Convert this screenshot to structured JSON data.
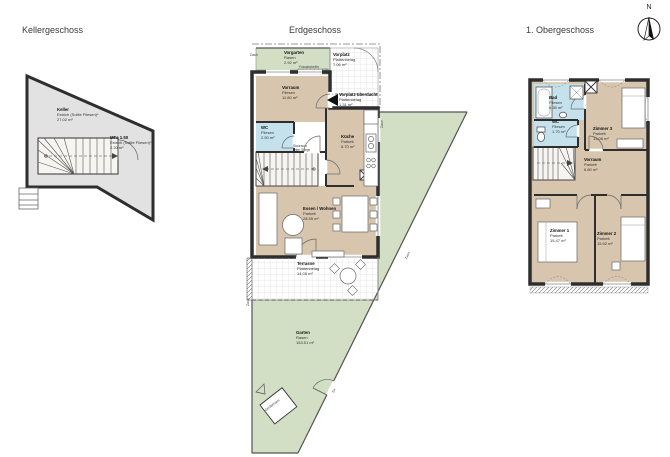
{
  "north_arrow": {
    "label": "N"
  },
  "colors": {
    "wood": "#d8c5ae",
    "tile_blue": "#c5e2ec",
    "grass": "#d2dfc5",
    "screed_gray": "#e2e2e2",
    "wall": "#2e2e2e"
  },
  "keller": {
    "title": "Kellergeschoss",
    "rooms": {
      "keller": {
        "name": "Keller",
        "floor": "Estrich (Sollte Fliesen)*",
        "area": "27.02 m²"
      },
      "stiege": {
        "name": "MFa 1.50",
        "floor": "Estrich (Sollte Fliesen)*",
        "area": "2.20 m²"
      }
    }
  },
  "eg": {
    "title": "Erdgeschoss",
    "annotations": {
      "dach": "Dach",
      "zaun": "Zaun",
      "tor": "Tor",
      "geraetehaus": "Gerätehaus",
      "stauraum_line1": "Stauraum",
      "stauraum_line2": "unter Stiege",
      "fussabstreifer": "Fussabstreifer"
    },
    "rooms": {
      "vorgarten": {
        "name": "Vorgarten",
        "floor": "Rasen",
        "area": "2.92 m²"
      },
      "vorplatz": {
        "name": "Vorplatz",
        "floor": "Plattenbelag",
        "area": "7.06 m²"
      },
      "vorplatz_ueberdacht": {
        "name": "Vorplatz überdacht",
        "floor": "Plattenbelag",
        "area": "1.31 m²"
      },
      "vorraum": {
        "name": "Vorraum",
        "floor": "Fliesen",
        "area": "11.80 m²"
      },
      "wc": {
        "name": "WC",
        "floor": "Fliesen",
        "area": "2.50 m²"
      },
      "kueche": {
        "name": "Küche",
        "floor": "Parkett",
        "area": "6.70 m²"
      },
      "essen_wohnen": {
        "name": "Essen / Wohnen",
        "floor": "Parkett",
        "area": "28.55 m²"
      },
      "terrasse": {
        "name": "Terrasse",
        "floor": "Plattenbelag",
        "area": "14.05 m²"
      },
      "garten": {
        "name": "Garten",
        "floor": "Rasen",
        "area": "153.51 m²"
      }
    }
  },
  "og": {
    "title": "1. Obergeschoss",
    "rooms": {
      "bad": {
        "name": "Bad",
        "floor": "Fliesen",
        "area": "6.35 m²"
      },
      "wc": {
        "name": "WC",
        "floor": "Fliesen",
        "area": "1.70 m²"
      },
      "zimmer3": {
        "name": "Zimmer 3",
        "floor": "Parkett",
        "area": "13.08 m²"
      },
      "vorraum": {
        "name": "Vorraum",
        "floor": "Parkett",
        "area": "6.80 m²"
      },
      "zimmer1": {
        "name": "Zimmer 1",
        "floor": "Parkett",
        "area": "15.47 m²"
      },
      "zimmer2": {
        "name": "Zimmer 2",
        "floor": "Parkett",
        "area": "15.92 m²"
      }
    }
  }
}
